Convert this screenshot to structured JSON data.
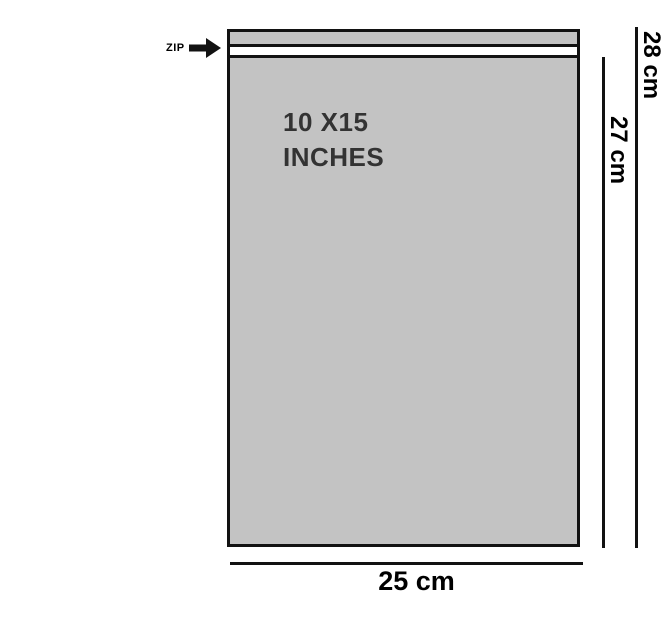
{
  "colors": {
    "background": "#ffffff",
    "bag_fill": "#c3c3c3",
    "line": "#121212",
    "size_text": "#333333"
  },
  "bag": {
    "size_label_line1": "10 X15",
    "size_label_line2": "INCHES"
  },
  "zip": {
    "label": "ZIP",
    "arrow_icon": "right-arrow"
  },
  "dimensions": {
    "overall_height_label": "28 cm",
    "body_height_label": "27 cm",
    "width_label": "25 cm"
  }
}
